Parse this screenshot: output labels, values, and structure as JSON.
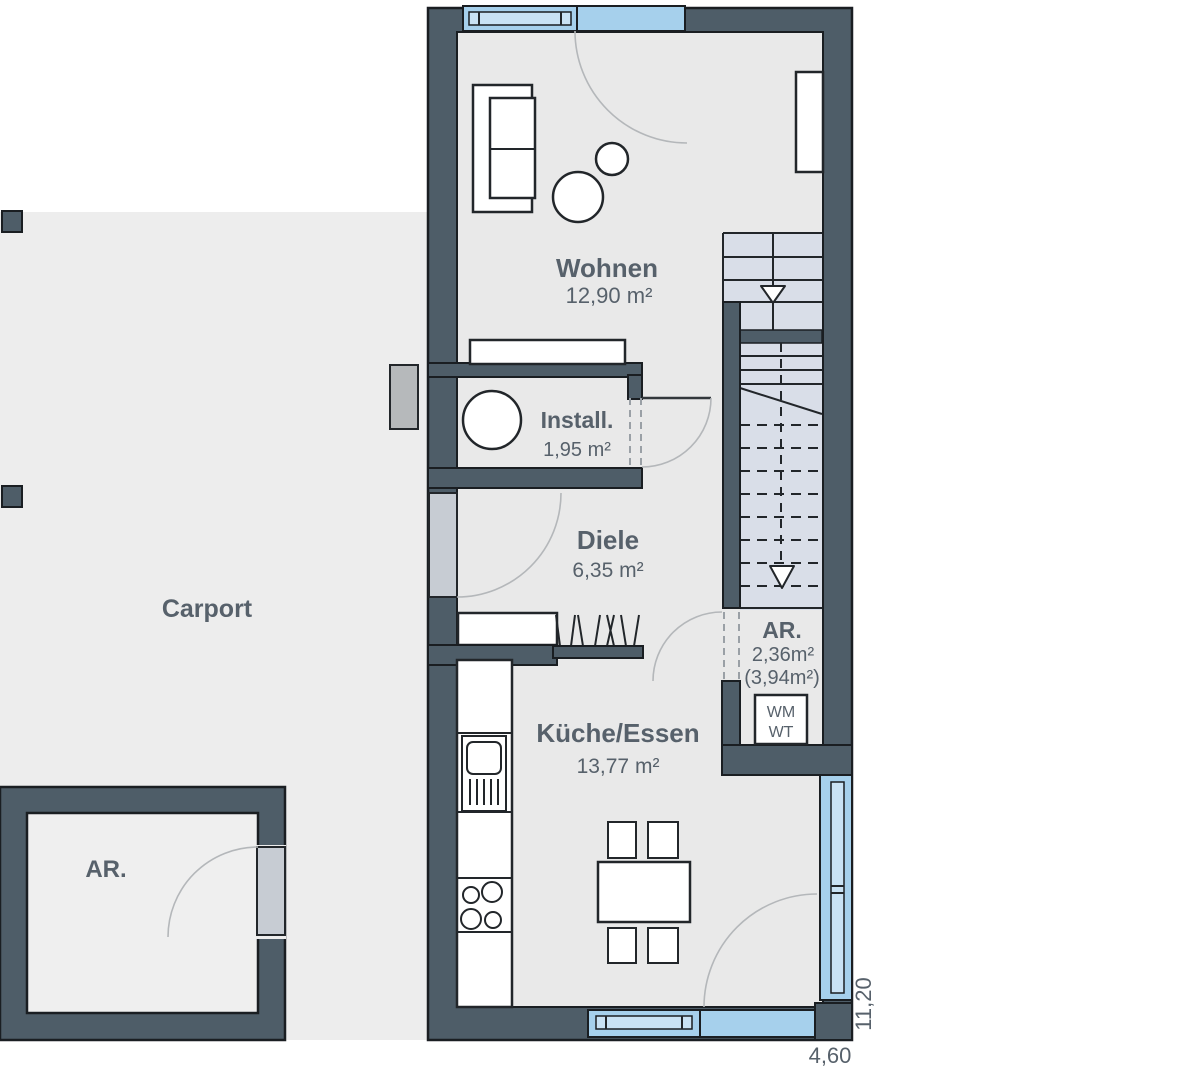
{
  "plan": {
    "rooms": {
      "wohnen": {
        "name": "Wohnen",
        "area": "12,90 m²"
      },
      "install": {
        "name": "Install.",
        "area": "1,95 m²"
      },
      "diele": {
        "name": "Diele",
        "area": "6,35 m²"
      },
      "abstellraum": {
        "name": "AR.",
        "area": "2,36m²",
        "area_total": "(3,94m²)"
      },
      "kueche": {
        "name": "Küche/Essen",
        "area": "13,77 m²"
      },
      "carport": {
        "name": "Carport"
      },
      "carport_abstellraum": {
        "name": "AR."
      }
    },
    "appliances": {
      "washing_machine": "WM",
      "dryer": "WT"
    },
    "dimensions": {
      "width": "4,60",
      "depth": "11,20"
    },
    "colors": {
      "wall": "#4e5d68",
      "outline": "#1a1e22",
      "floor": "#e9e9e9",
      "carport_floor": "#ededed",
      "stair_fill": "#d9dee8",
      "window_glass": "#a6d0ec",
      "window_frame": "#c9e2f4",
      "door_leaf": "#c7ccd3",
      "label_text": "#57616b"
    }
  }
}
